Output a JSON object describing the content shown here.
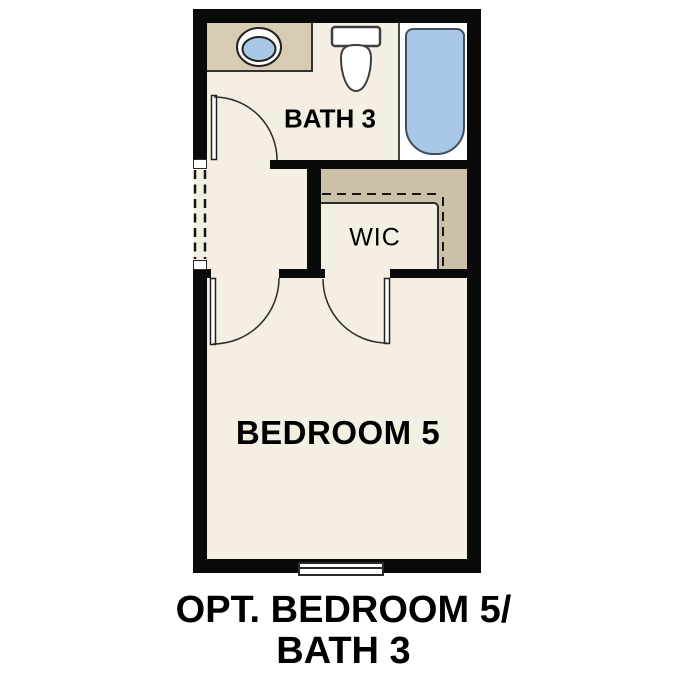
{
  "figure": {
    "caption": {
      "line1": "OPT. BEDROOM 5/",
      "line2": "BATH 3"
    },
    "labels": {
      "bath": "BATH 3",
      "wic": "WIC",
      "bedroom": "BEDROOM 5"
    },
    "colors": {
      "floor_cream": "#f5eee2",
      "counter_tan": "#d7cbb2",
      "closet_tan": "#ccc0a8",
      "fixture_blue": "#a9c7e6",
      "wall_black": "#0a0a0a",
      "line_dark": "#2b2b2b",
      "text_black": "#000000"
    },
    "fixtures": [
      {
        "name": "sink-icon"
      },
      {
        "name": "toilet-icon"
      },
      {
        "name": "bathtub-icon"
      },
      {
        "name": "window-icon"
      }
    ]
  }
}
